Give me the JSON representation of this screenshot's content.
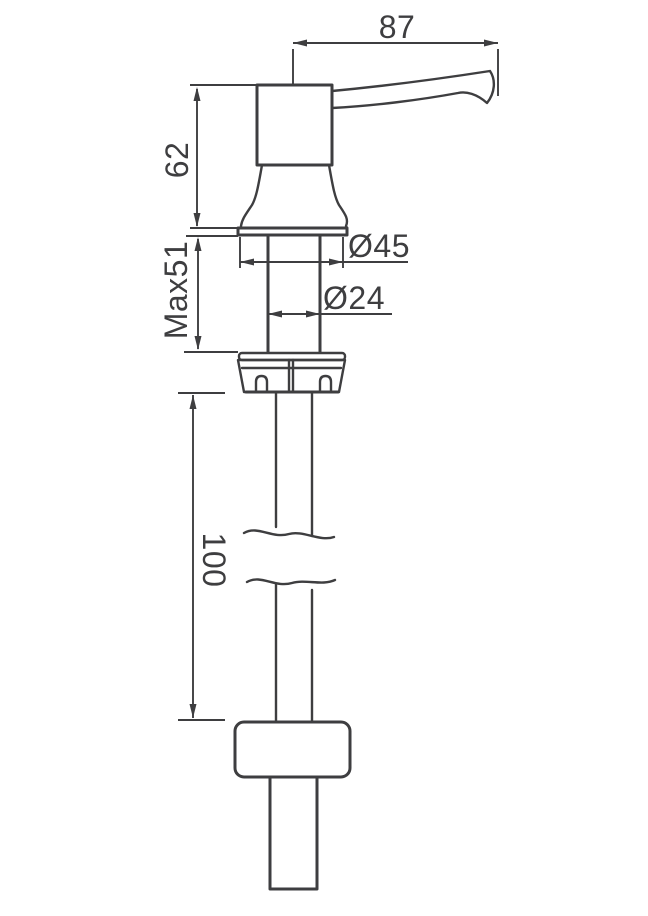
{
  "diagram": {
    "kind": "technical-dimension-drawing",
    "subject": "deck-mounted-soap-dispenser-pump-side-view",
    "line_color": "#3e3e40",
    "background_color": "#ffffff",
    "labels": {
      "spout_reach": "87",
      "head_height": "62",
      "max_mount_thickness": "Max51",
      "flange_diameter": "Ø45",
      "body_diameter": "Ø24",
      "tube_length": "100"
    }
  }
}
